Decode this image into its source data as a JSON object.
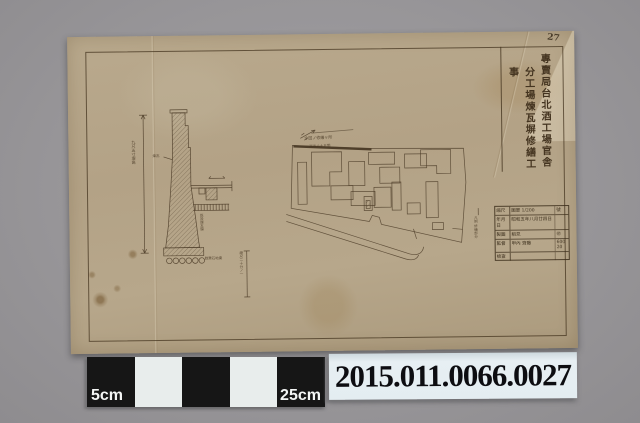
{
  "photo": {
    "background_color": "#98969a",
    "paper_color": "#b5a489",
    "ink_color": "#4a3a26"
  },
  "drawing": {
    "page_number": "27",
    "title_lines": [
      "專賣局台北酒工場官舎",
      "分工場煉瓦塀修繕工事"
    ],
    "annotations": {
      "section_height_dim": "九尺五寸塀高",
      "section_brick": "煉瓦",
      "section_existing_wall": "既設煉瓦塀",
      "section_footing": "割栗石地業",
      "section_scale_note": "縮尺二十分ノ一",
      "plan_repair_label": "今回ノ修繕ヶ所",
      "plan_length_label": "延長六十五間",
      "plan_legend": "凡例 修繕部分"
    },
    "title_block": {
      "rows": [
        {
          "label": "縮尺",
          "value": "圖單 1/200",
          "value2": "號"
        },
        {
          "label": "年月日",
          "value": "昭和五年八月廿四日",
          "value2": ""
        },
        {
          "label": "製圖",
          "value": "稻見",
          "value2": "㊞"
        },
        {
          "label": "監督",
          "value": "甲內 齊藤",
          "value2": "600 20"
        },
        {
          "label": "檢查",
          "value": "",
          "value2": ""
        }
      ]
    }
  },
  "scale_bar": {
    "left_label": "5cm",
    "right_label": "25cm"
  },
  "accession": {
    "number": "2015.011.0066.0027"
  }
}
